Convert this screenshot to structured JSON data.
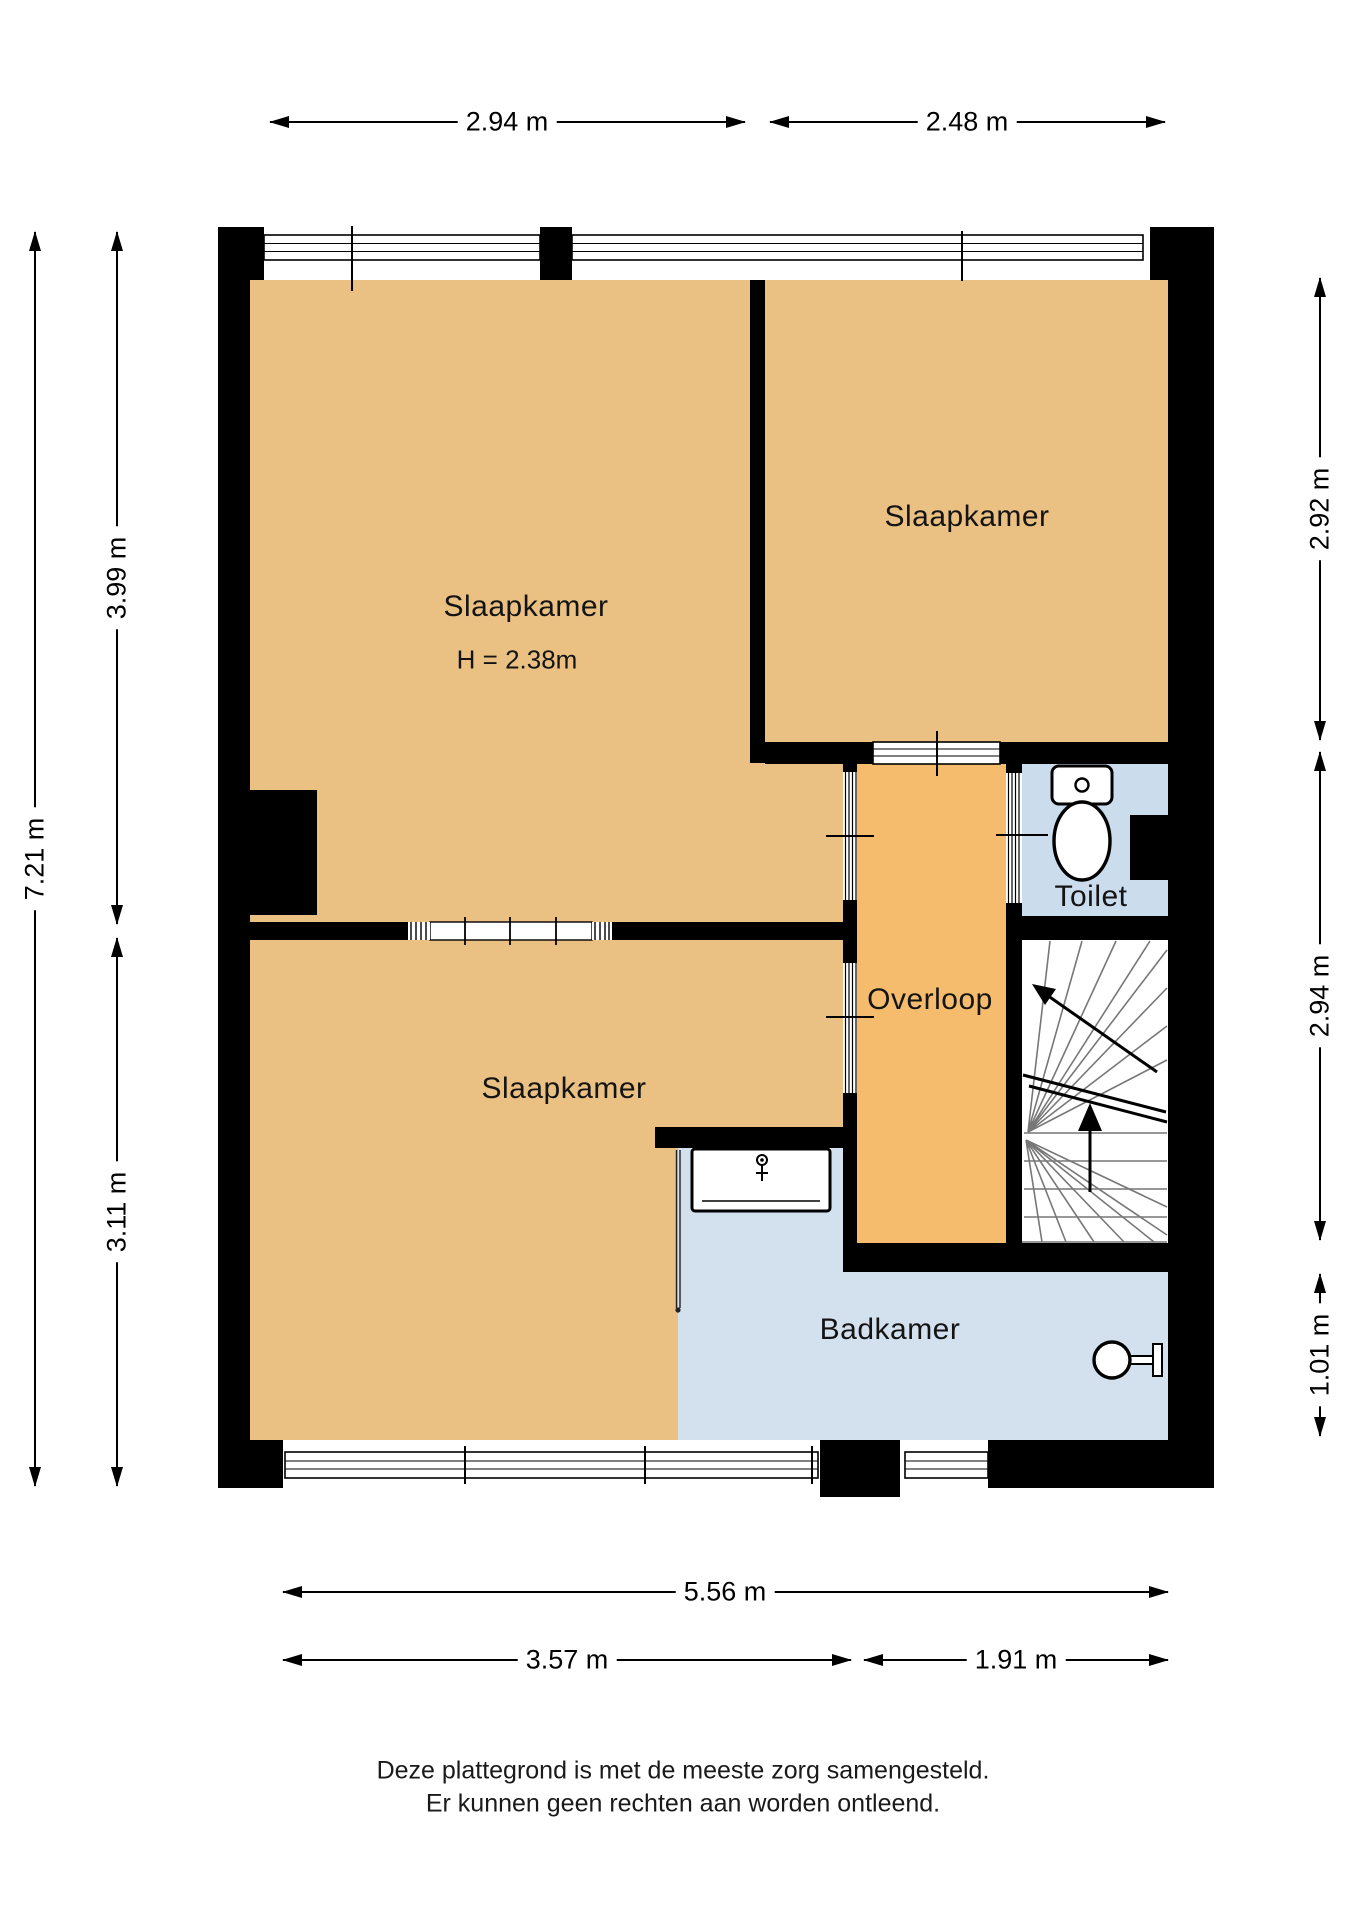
{
  "rooms": {
    "bedroom_top_left": {
      "label": "Slaapkamer",
      "ceiling_height_note": "H = 2.38m"
    },
    "bedroom_top_right": {
      "label": "Slaapkamer"
    },
    "bedroom_bottom_left": {
      "label": "Slaapkamer"
    },
    "landing": {
      "label": "Overloop"
    },
    "toilet": {
      "label": "Toilet"
    },
    "bathroom": {
      "label": "Badkamer"
    }
  },
  "dimensions": {
    "top": [
      "2.94 m",
      "2.48 m"
    ],
    "left": [
      "7.21 m",
      "3.99 m",
      "3.11 m"
    ],
    "right": [
      "2.92 m",
      "2.94 m",
      "1.01 m"
    ],
    "bottom": [
      "5.56 m",
      "3.57 m",
      "1.91 m"
    ]
  },
  "disclaimer": [
    "Deze plattegrond is met de meeste zorg samengesteld.",
    "Er kunnen geen rechten aan worden ontleend."
  ],
  "colors": {
    "bedroom_fill": "#EBC183",
    "landing_fill": "#F4BC6C",
    "toilet_fill": "#CBDCEC",
    "bathroom_fill": "#D3E0EE",
    "wall": "#000000",
    "stair_tread": "#777777"
  },
  "icons": [
    "toilet-icon",
    "bathtub-icon",
    "washbasin-icon",
    "stairs-up-arrow-icon",
    "stairs-entry-arrow-icon",
    "dimension-arrow-icon"
  ]
}
